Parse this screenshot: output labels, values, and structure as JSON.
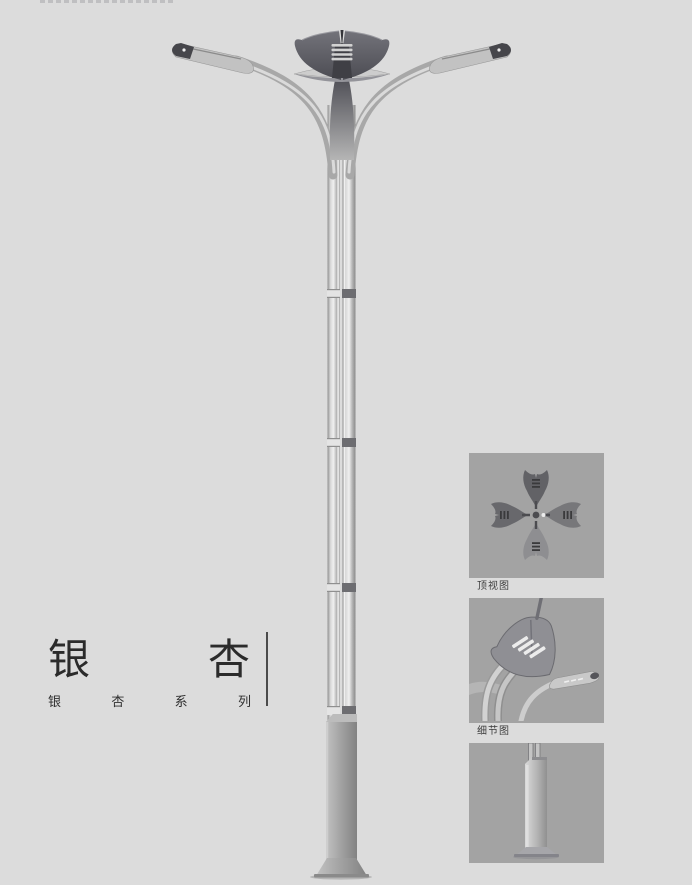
{
  "page": {
    "background_color": "#dcdcdc",
    "panel_background_color": "#a3a3a3",
    "text_color": "#2b2b2b"
  },
  "product": {
    "title": "银杏",
    "title_chars": [
      "银",
      "杏"
    ],
    "series_label": "银杏系列",
    "series_chars": [
      "银",
      "杏",
      "系",
      "列"
    ]
  },
  "panels": [
    {
      "id": "top-view",
      "label": "顶视图"
    },
    {
      "id": "detail-view",
      "label": "细节图"
    },
    {
      "id": "base-view",
      "label": ""
    }
  ],
  "illustration": {
    "subject": "ginkgo-series-double-arm-street-light",
    "metal_light_color": "#d8d8d8",
    "metal_dark_color": "#55555b"
  }
}
